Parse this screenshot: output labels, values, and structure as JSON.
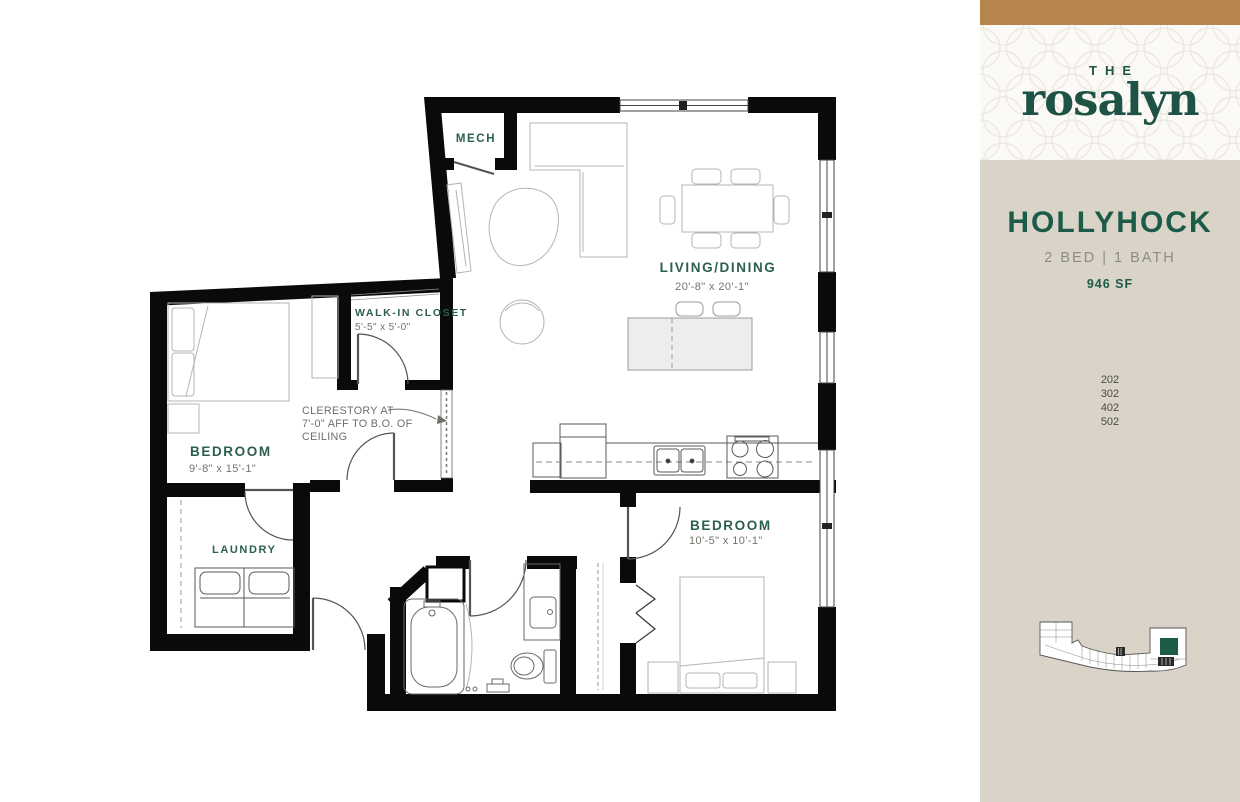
{
  "colors": {
    "accent_tan": "#b5854d",
    "brand_green": "#1d5b49",
    "sidebar_beige": "#d9d4c7",
    "plan_label_green": "#2d5f4e",
    "dim_gray": "#73736d",
    "wall_black": "#0a0a0a",
    "keyplan_highlight": "#1d5b49"
  },
  "sidebar": {
    "logo": {
      "the": "THE",
      "name": "rosalyn"
    },
    "plan_name": "HOLLYHOCK",
    "plan_specs": "2 BED | 1 BATH",
    "plan_area": "946 SF",
    "units": [
      "202",
      "302",
      "402",
      "502"
    ]
  },
  "floorplan": {
    "rooms": {
      "mech": {
        "label": "MECH"
      },
      "living": {
        "label": "LIVING/DINING",
        "dims": "20'-8\" x 20'-1\""
      },
      "walk_in_closet": {
        "label": "WALK-IN CLOSET",
        "dims": "5'-5\" x 5'-0\""
      },
      "bedroom_1": {
        "label": "BEDROOM",
        "dims": "9'-8\" x 15'-1\""
      },
      "laundry": {
        "label": "LAUNDRY"
      },
      "bedroom_2": {
        "label": "BEDROOM",
        "dims": "10'-5\" x 10'-1\""
      }
    },
    "annotation": {
      "lines": [
        "CLERESTORY AT",
        "7'-0\" AFF TO B.O. OF",
        "CEILING"
      ]
    }
  }
}
